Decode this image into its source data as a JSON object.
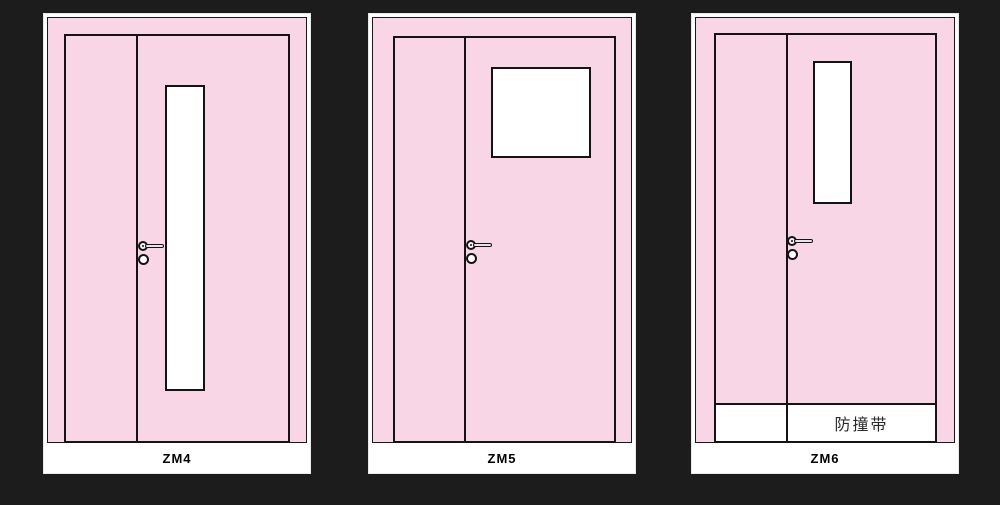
{
  "page": {
    "background_color": "#1c1c1c"
  },
  "colors": {
    "door_pink": "#f8d6e5",
    "outline_black": "#141414",
    "panel_white": "#ffffff",
    "caption_text": "#000000",
    "bumper_text": "#2a2a2a"
  },
  "doors": [
    {
      "id": "zm4",
      "label": "ZM4",
      "type": "unequal double leaf door",
      "window": "tall narrow vertical vision panel"
    },
    {
      "id": "zm5",
      "label": "ZM5",
      "type": "unequal double leaf door",
      "window": "square vision panel near top"
    },
    {
      "id": "zm6",
      "label": "ZM6",
      "type": "unequal double leaf door",
      "window": "short vertical vision panel",
      "bumper_label": "防撞带"
    }
  ]
}
